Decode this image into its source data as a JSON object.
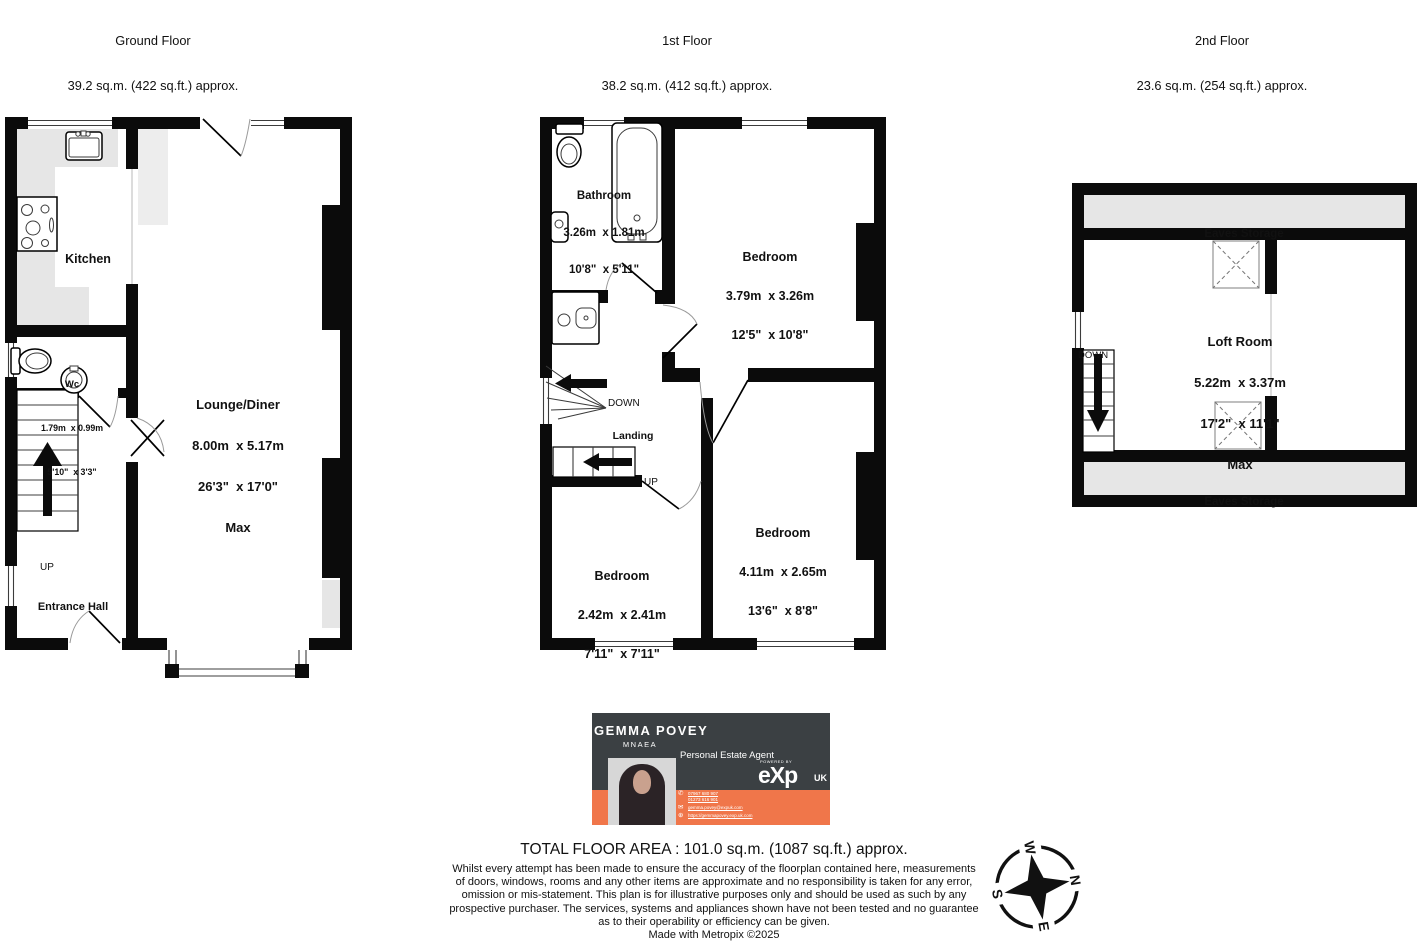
{
  "floors": {
    "ground": {
      "title": "Ground Floor",
      "area": "39.2 sq.m. (422 sq.ft.) approx."
    },
    "first": {
      "title": "1st Floor",
      "area": "38.2 sq.m. (412 sq.ft.) approx."
    },
    "second": {
      "title": "2nd Floor",
      "area": "23.6 sq.m. (254 sq.ft.) approx."
    }
  },
  "rooms": {
    "kitchen": {
      "name": "Kitchen"
    },
    "wc": {
      "name": "Wc",
      "dim_m": "1.79m  x 0.99m",
      "dim_ft": "5'10\"  x 3'3\""
    },
    "lounge": {
      "name": "Lounge/Diner",
      "dim_m": "8.00m  x 5.17m",
      "dim_ft": "26'3\"  x 17'0\"",
      "max": "Max"
    },
    "entrance": {
      "name": "Entrance Hall"
    },
    "bathroom": {
      "name": "Bathroom",
      "dim_m": "3.26m  x 1.81m",
      "dim_ft": "10'8\"  x 5'11\""
    },
    "bedroom1": {
      "name": "Bedroom",
      "dim_m": "3.79m  x 3.26m",
      "dim_ft": "12'5\"  x 10'8\""
    },
    "bedroom2": {
      "name": "Bedroom",
      "dim_m": "4.11m  x 2.65m",
      "dim_ft": "13'6\"  x 8'8\""
    },
    "bedroom3": {
      "name": "Bedroom",
      "dim_m": "2.42m  x 2.41m",
      "dim_ft": "7'11\"  x 7'11\""
    },
    "landing": {
      "name": "Landing"
    },
    "loft": {
      "name": "Loft Room",
      "dim_m": "5.22m  x 3.37m",
      "dim_ft": "17'2\"  x 11'1\"",
      "max": "Max"
    },
    "eaves_top": {
      "name": "Eaves Storage"
    },
    "eaves_bottom": {
      "name": "Eaves Storage"
    }
  },
  "stairs": {
    "up": "UP",
    "down": "DOWN"
  },
  "compass": {
    "n": "N",
    "e": "E",
    "s": "S",
    "w": "W"
  },
  "branding": {
    "name": "GEMMA POVEY",
    "credentials": "MNAEA",
    "role": "Personal Estate Agent",
    "logo_powered": "POWERED BY",
    "logo": "eXp",
    "logo_region": "UK",
    "phone_icon": "✆",
    "email_icon": "✉",
    "web_icon": "⊕",
    "phone1": "07967 680 907",
    "phone2": "01273 616 901",
    "email": "gemma.povey@expuk.com",
    "website": "https://gemmapovey.exp.uk.com"
  },
  "footer": {
    "total_area": "TOTAL FLOOR AREA : 101.0 sq.m. (1087 sq.ft.) approx.",
    "disclaimer_lines": [
      "Whilst every attempt has been made to ensure the accuracy of the floorplan contained here, measurements",
      "of doors, windows, rooms and any other items are approximate and no responsibility is taken for any error,",
      "omission or mis-statement. This plan is for illustrative purposes only and should be used as such by any",
      "prospective purchaser. The services, systems and appliances shown have not been tested and no guarantee",
      "as to their operability or efficiency can be given."
    ],
    "made_with": "Made with Metropix ©2025"
  }
}
